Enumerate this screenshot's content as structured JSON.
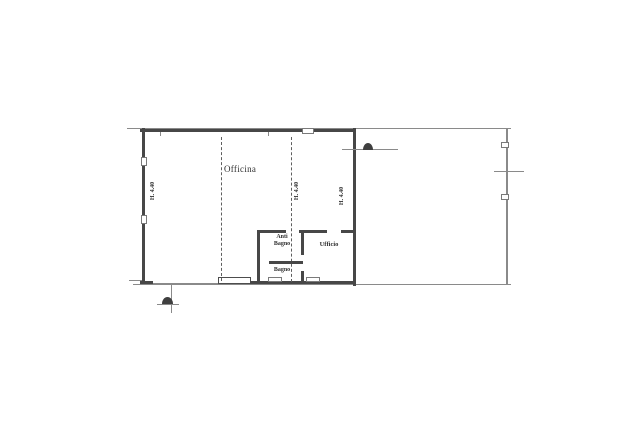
{
  "document": {
    "type": "scanned floor plan",
    "language": "Italian"
  },
  "plan": {
    "rooms": [
      {
        "name": "officina",
        "label": "Officina"
      },
      {
        "name": "anti-bagno",
        "label": "Anti Bagno",
        "line1": "Anti",
        "line2": "Bagno"
      },
      {
        "name": "bagno",
        "label": "Bagno"
      },
      {
        "name": "ufficio",
        "label": "Ufficio"
      }
    ],
    "height_labels": [
      {
        "text": "H. 4.40",
        "position": "left-wall"
      },
      {
        "text": "H. 4.40",
        "position": "center-bay"
      },
      {
        "text": "H. 4.40",
        "position": "right-wall"
      }
    ],
    "colors": {
      "background": "#ffffff",
      "wall": "#474747",
      "thin_line": "#8a8a8a",
      "dashed_line": "#5f5f5f",
      "text": "#2f2f2f"
    }
  }
}
